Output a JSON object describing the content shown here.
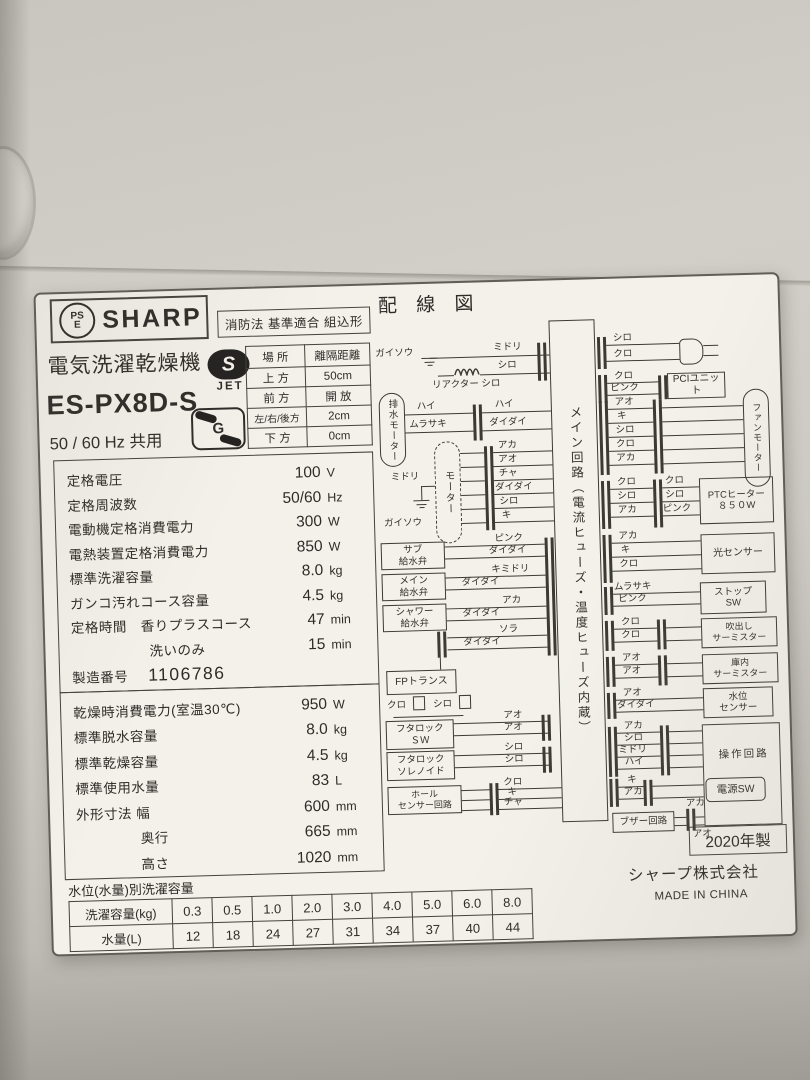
{
  "label": {
    "header": {
      "pse_top": "PS",
      "pse_bottom": "E",
      "brand": "SHARP",
      "fire_law": "消防法 基準適合 組込形"
    },
    "product": {
      "type_name": "電気洗濯乾燥機",
      "jet_s": "S",
      "jet_mark": "JET",
      "model": "ES-PX8D-S",
      "g_mark": "G",
      "frequency": "50 / 60 Hz 共用"
    },
    "clearance": {
      "col_place": "場 所",
      "col_distance": "離隔距離",
      "rows": [
        {
          "place": "上 方",
          "distance": "50cm"
        },
        {
          "place": "前 方",
          "distance": "開 放"
        },
        {
          "place": "左/右/後方",
          "distance": "2cm"
        },
        {
          "place": "下 方",
          "distance": "0cm"
        }
      ]
    },
    "specs1": [
      {
        "label": "定格電圧",
        "value": "100",
        "unit": "V"
      },
      {
        "label": "定格周波数",
        "value": "50/60",
        "unit": "Hz"
      },
      {
        "label": "電動機定格消費電力",
        "value": "300",
        "unit": "W"
      },
      {
        "label": "電熱装置定格消費電力",
        "value": "850",
        "unit": "W"
      },
      {
        "label": "標準洗濯容量",
        "value": "8.0",
        "unit": "kg"
      },
      {
        "label": "ガンコ汚れコース容量",
        "value": "4.5",
        "unit": "kg"
      },
      {
        "label": "定格時間　香りプラスコース",
        "value": "47",
        "unit": "min"
      },
      {
        "label": "洗いのみ",
        "value": "15",
        "unit": "min"
      }
    ],
    "serial": {
      "label": "製造番号",
      "value": "1106786"
    },
    "specs2": [
      {
        "label": "乾燥時消費電力(室温30℃)",
        "value": "950",
        "unit": "W"
      },
      {
        "label": "標準脱水容量",
        "value": "8.0",
        "unit": "kg"
      },
      {
        "label": "標準乾燥容量",
        "value": "4.5",
        "unit": "kg"
      },
      {
        "label": "標準使用水量",
        "value": "83",
        "unit": "L"
      },
      {
        "label": "外形寸法 幅",
        "value": "600",
        "unit": "mm"
      },
      {
        "label": "奥行",
        "value": "665",
        "unit": "mm"
      },
      {
        "label": "高さ",
        "value": "1020",
        "unit": "mm"
      }
    ],
    "water_table": {
      "title": "水位(水量)別洗濯容量",
      "capacity_label": "洗濯容量(kg)",
      "capacities": [
        "0.3",
        "0.5",
        "1.0",
        "2.0",
        "3.0",
        "4.0",
        "5.0",
        "6.0",
        "8.0"
      ],
      "amount_label": "水量(L)",
      "amounts": [
        "12",
        "18",
        "24",
        "27",
        "31",
        "34",
        "37",
        "40",
        "44"
      ]
    },
    "wiring": {
      "title": "配 線 図",
      "main_circuit": "メイン回路（電流ヒューズ・温度ヒューズ内蔵）",
      "ground_left": {
        "label": "ガイソウ",
        "wire1": "ミドリ",
        "wire2": "シロ",
        "reactor": "リアクター",
        "reactor_wire": "シロ"
      },
      "drain_motor": {
        "name": "排水モーター",
        "w1": "ハイ",
        "w2": "ムラサキ",
        "w3": "ハイ",
        "w4": "ダイダイ"
      },
      "motor": {
        "name": "モーター",
        "wires": [
          "アカ",
          "アオ",
          "チャ",
          "ダイダイ",
          "シロ",
          "キ"
        ],
        "ground_wire": "ミドリ",
        "ground_label": "ガイソウ"
      },
      "valves": {
        "sub": "サブ\n給水弁",
        "main": "メイン\n給水弁",
        "shower": "シャワー\n給水弁",
        "wires": [
          "ピンク",
          "ダイダイ",
          "キミドリ",
          "ダイダイ",
          "アカ",
          "ダイダイ",
          "ソラ",
          "ダイダイ"
        ]
      },
      "fp_trans": {
        "name": "FPトランス",
        "w1": "クロ",
        "w2": "シロ"
      },
      "lid_lock_sw": {
        "name": "フタロック\nＳＷ",
        "wires": [
          "アオ",
          "アオ"
        ]
      },
      "lid_lock_sol": {
        "name": "フタロック\nソレノイド",
        "wires": [
          "シロ",
          "シロ"
        ]
      },
      "hall_sensor": {
        "name": "ホール\nセンサー回路",
        "wires": [
          "クロ",
          "キ",
          "チャ"
        ]
      },
      "power_cord": {
        "w1": "シロ",
        "w2": "クロ"
      },
      "pci": {
        "name": "PCIユニット",
        "w1": "クロ",
        "w2": "ピンク"
      },
      "fan_motor": {
        "name": "ファンモーター",
        "wires": [
          "アオ",
          "キ",
          "シロ",
          "クロ",
          "アカ"
        ]
      },
      "ptc": {
        "name": "PTCヒーター\n８５０W",
        "left_wires": [
          "クロ",
          "シロ",
          "アカ"
        ],
        "right_wires": [
          "クロ",
          "シロ",
          "ピンク"
        ]
      },
      "light_sensor": {
        "name": "光センサー",
        "wires": [
          "アカ",
          "キ",
          "クロ"
        ]
      },
      "stop_sw": {
        "name": "ストップ\nSW",
        "wires": [
          "ムラサキ",
          "ピンク"
        ]
      },
      "outlet_thermistor": {
        "name": "吹出し\nサーミスター",
        "wires": [
          "クロ",
          "クロ"
        ]
      },
      "chamber_thermistor": {
        "name": "庫内\nサーミスター",
        "wires": [
          "アオ",
          "アオ"
        ]
      },
      "water_level_sensor": {
        "name": "水位\nセンサー",
        "wires": [
          "アオ",
          "ダイダイ"
        ]
      },
      "operation_circuit": {
        "name": "操作回路",
        "wires": [
          "アカ",
          "シロ",
          "ミドリ",
          "ハイ"
        ]
      },
      "power_sw": {
        "name": "電源SW",
        "wires": [
          "キ",
          "アカ"
        ]
      },
      "buzzer": {
        "name": "ブザー回路",
        "wires": [
          "アカ",
          "アオ"
        ]
      }
    },
    "footer": {
      "year": "2020年製",
      "company": "シャープ株式会社",
      "origin": "MADE IN CHINA"
    }
  }
}
